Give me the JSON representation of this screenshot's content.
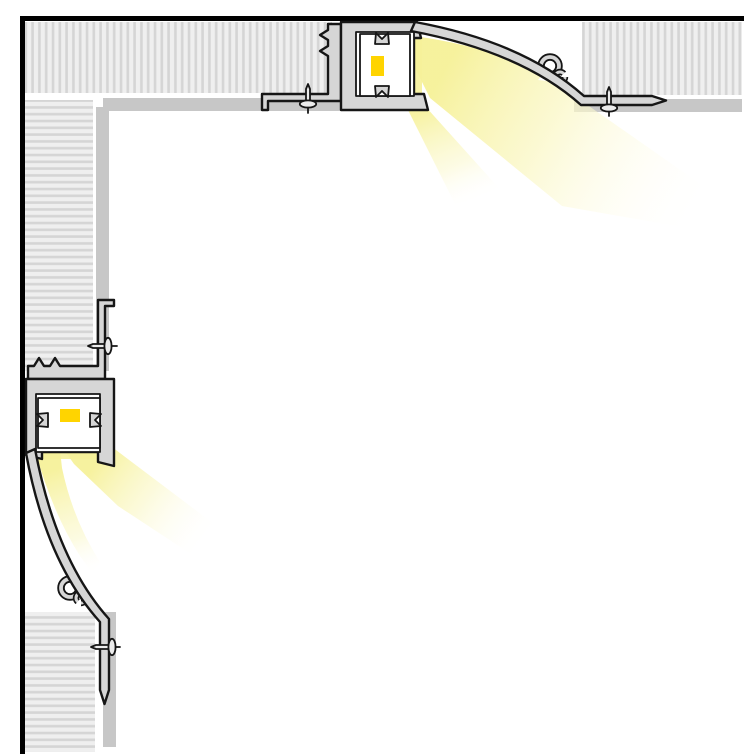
{
  "meta": {
    "title": "Recessed trim-less LED drywall profile - corner cross-section installation diagram",
    "diagram_type": "technical cross-section",
    "visible_text": []
  },
  "colors": {
    "background": "#ffffff",
    "frame": "#000000",
    "outline": "#161616",
    "aluminum": "#d6d6d6",
    "plaster_skim": "#c7c7c7",
    "drywall_light": "#efefef",
    "drywall_stripe": "#d5d5d5",
    "module_fill": "#ffffff",
    "led_yellow": "#ffd400",
    "light_core": "#f6f19a",
    "light_mid": "#faf7c4",
    "light_faint": "#fffdf0",
    "screw_fill": "#ececec"
  },
  "components": {
    "assemblies": [
      {
        "id": "ceiling-profile",
        "orientation": "horizontal, light cast down-right"
      },
      {
        "id": "wall-profile",
        "orientation": "vertical, light cast down-right"
      }
    ],
    "parts": [
      "drywall-board",
      "plaster-skim-layer",
      "mounting-flange",
      "flange-screw",
      "anchor-stem",
      "led-housing-channel",
      "led-strip-module",
      "led-emitter",
      "cove-reflector-curve",
      "spring-clip",
      "light-beam"
    ],
    "counts": {
      "drywall_boards": 4,
      "plaster_skim_bands": 4,
      "screws": 4,
      "led_modules": 2,
      "spring_clips": 2,
      "light_beams": 4
    }
  }
}
